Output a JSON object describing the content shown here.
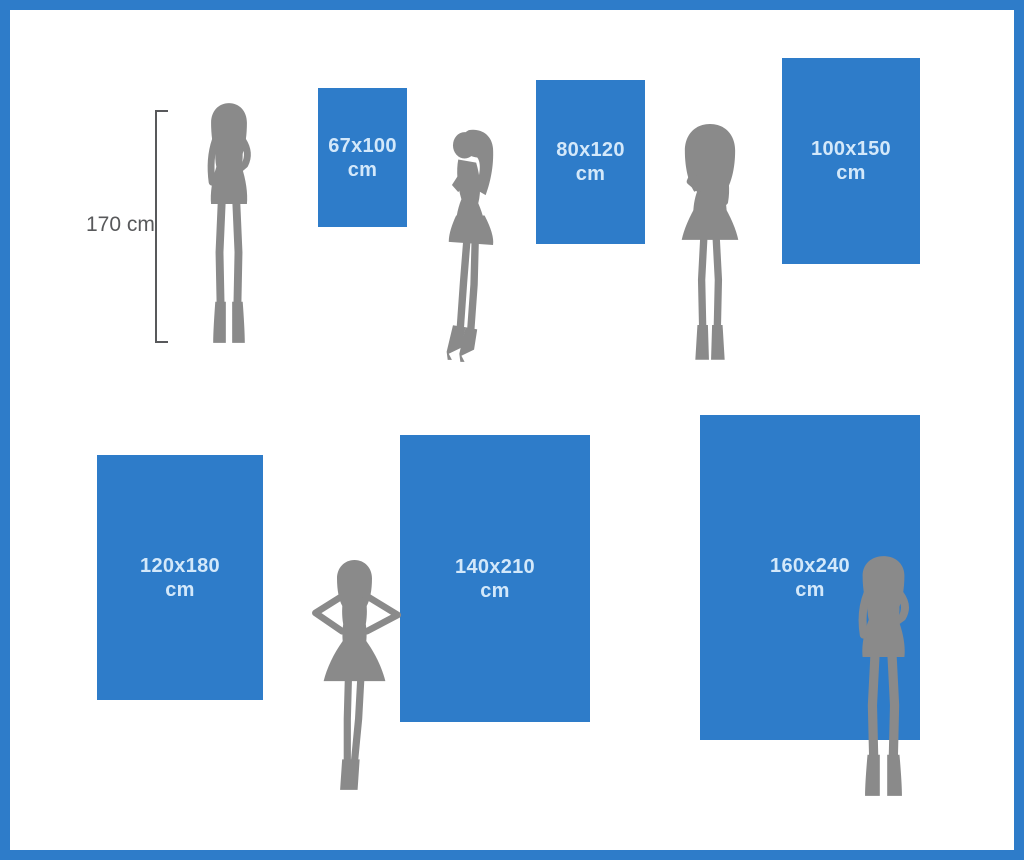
{
  "person": {
    "height_label": "170 cm"
  },
  "sizes": [
    {
      "dimensions": "67x100",
      "unit": "cm"
    },
    {
      "dimensions": "80x120",
      "unit": "cm"
    },
    {
      "dimensions": "100x150",
      "unit": "cm"
    },
    {
      "dimensions": "120x180",
      "unit": "cm"
    },
    {
      "dimensions": "140x210",
      "unit": "cm"
    },
    {
      "dimensions": "160x240",
      "unit": "cm"
    }
  ],
  "colors": {
    "accent-blue": "#2e7cc9",
    "panel-text": "#d3e8fa",
    "silhouette-gray": "#8a8a8a",
    "measure-gray": "#58595b",
    "background": "#ffffff"
  }
}
